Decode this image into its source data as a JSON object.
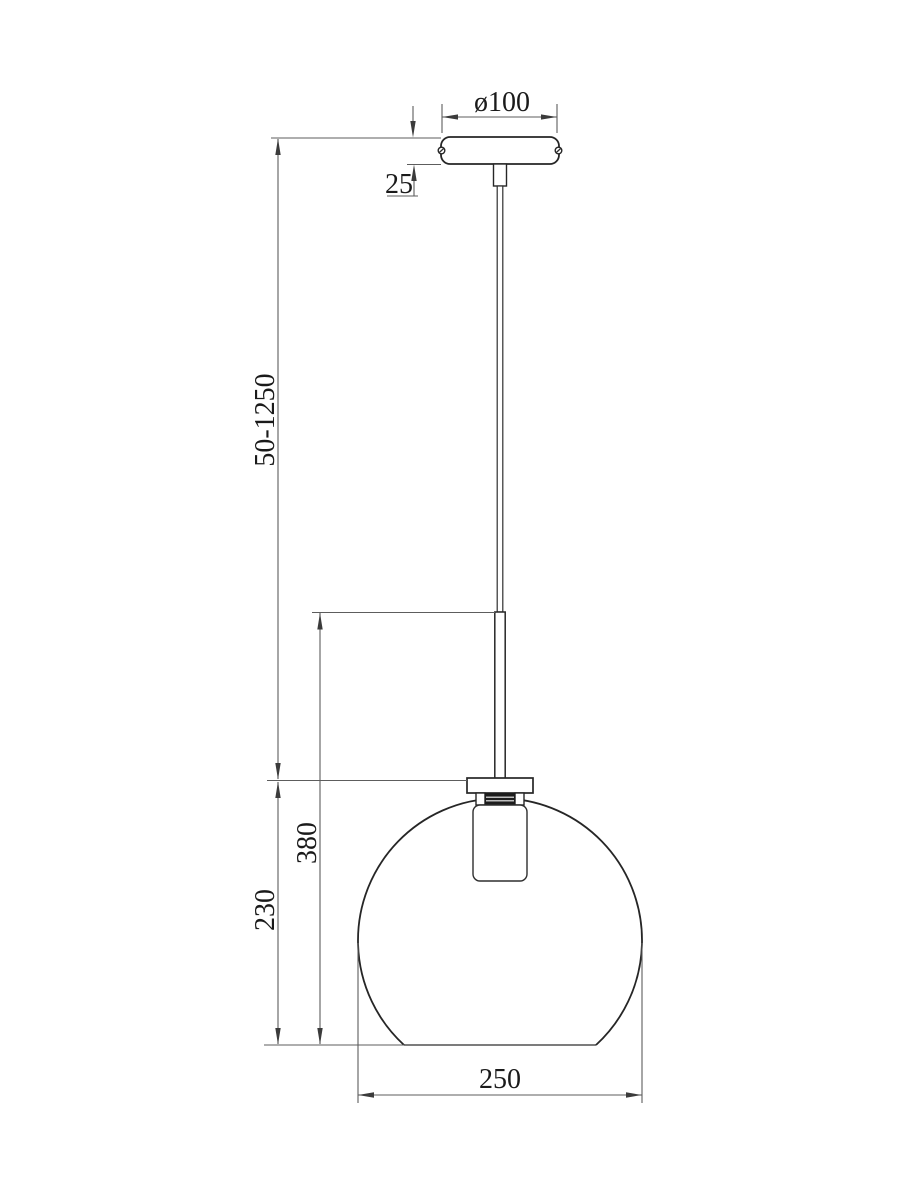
{
  "drawing": {
    "kind": "pendant-lamp-dimension-drawing",
    "dimensions": {
      "canopy_diameter": "ø100",
      "canopy_height": "25",
      "suspension_length": "50-1250",
      "body_height": "380",
      "shade_height": "230",
      "shade_diameter": "250"
    },
    "colors": {
      "background": "#ffffff",
      "object_line": "#262626",
      "dimension_line": "#5d5d5d",
      "label_text": "#1a1a1a"
    }
  }
}
